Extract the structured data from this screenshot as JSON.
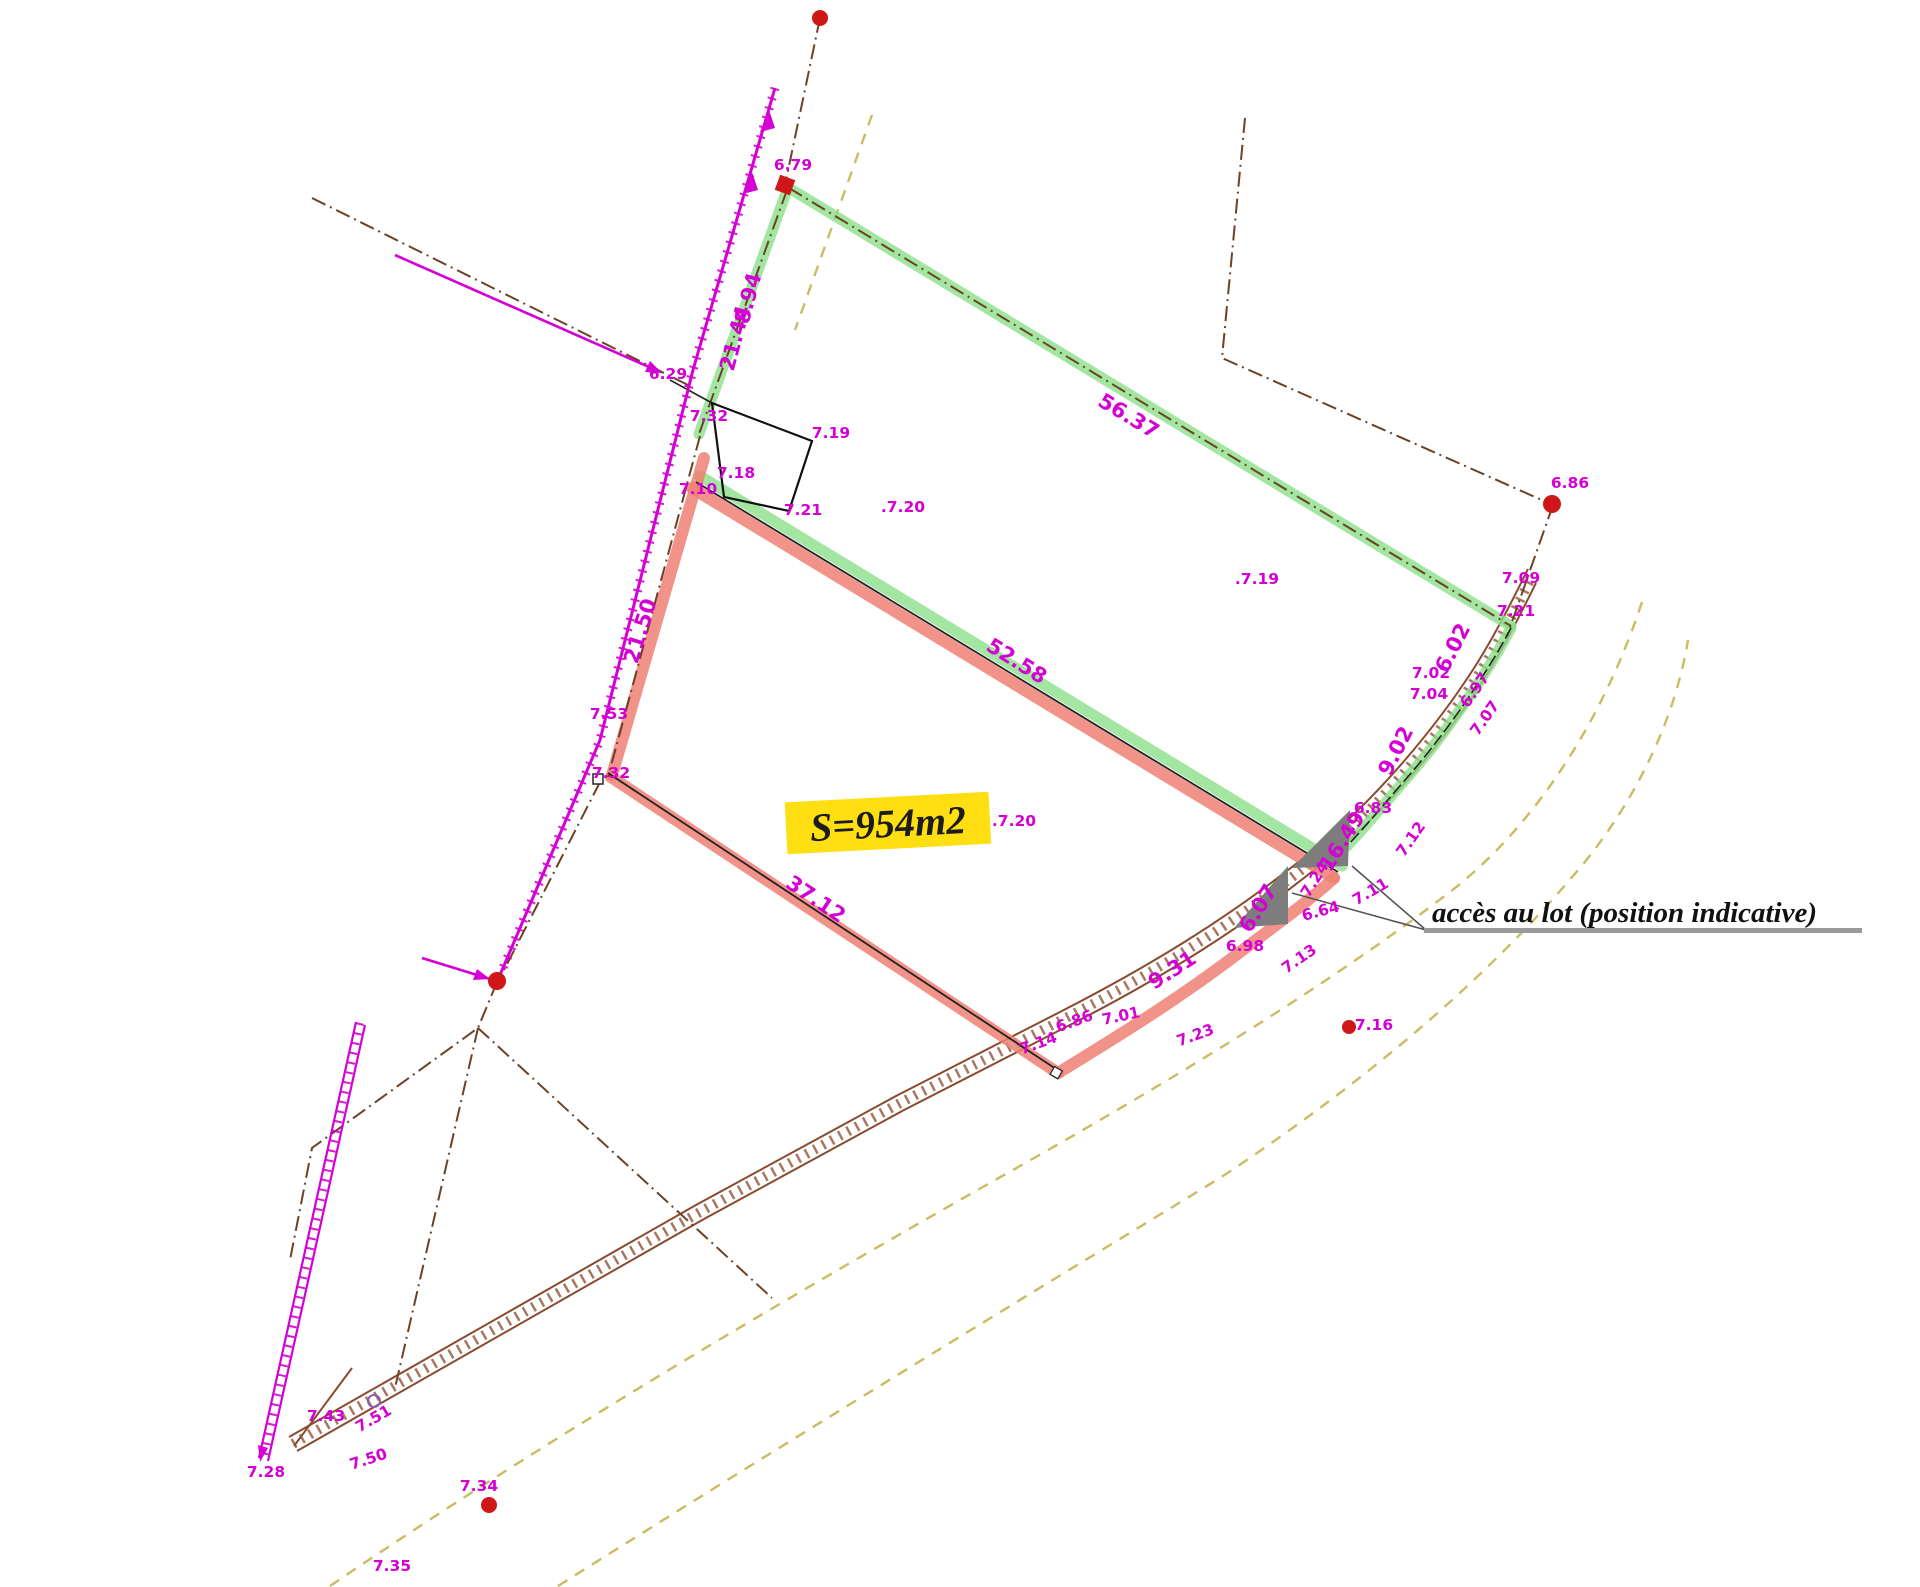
{
  "annotations": {
    "area": {
      "text": "S=954m2"
    },
    "access": {
      "text": "accès au lot (position indicative)"
    }
  },
  "labels": {
    "dimensions": [
      {
        "text": "8.94",
        "x": 755,
        "y": 300,
        "rot": -75
      },
      {
        "text": "21.44",
        "x": 742,
        "y": 340,
        "rot": -75
      },
      {
        "text": "21.50",
        "x": 647,
        "y": 633,
        "rot": -73
      },
      {
        "text": "56.37",
        "x": 1125,
        "y": 422,
        "rot": 31
      },
      {
        "text": "52.58",
        "x": 1013,
        "y": 667,
        "rot": 32
      },
      {
        "text": "37.12",
        "x": 812,
        "y": 905,
        "rot": 34
      },
      {
        "text": "16.49",
        "x": 1348,
        "y": 845,
        "rot": -58
      },
      {
        "text": "9.02",
        "x": 1402,
        "y": 754,
        "rot": -63
      },
      {
        "text": "9.31",
        "x": 1176,
        "y": 976,
        "rot": -33
      },
      {
        "text": "6.02",
        "x": 1459,
        "y": 651,
        "rot": -63
      },
      {
        "text": "6.07",
        "x": 1264,
        "y": 912,
        "rot": -58
      }
    ],
    "elevations": [
      {
        "text": "6.79",
        "x": 793,
        "y": 170
      },
      {
        "text": "6.29",
        "x": 668,
        "y": 379
      },
      {
        "text": "7.32",
        "x": 709,
        "y": 421
      },
      {
        "text": "7.19",
        "x": 831,
        "y": 438
      },
      {
        "text": "7.18",
        "x": 736,
        "y": 478
      },
      {
        "text": "7.10",
        "x": 698,
        "y": 494
      },
      {
        "text": "7.21",
        "x": 803,
        "y": 515
      },
      {
        "text": ".7.20",
        "x": 903,
        "y": 512
      },
      {
        "text": ".7.19",
        "x": 1257,
        "y": 584
      },
      {
        "text": "6.86",
        "x": 1570,
        "y": 488
      },
      {
        "text": "7.09",
        "x": 1521,
        "y": 583
      },
      {
        "text": "7.21",
        "x": 1516,
        "y": 616
      },
      {
        "text": "7.02",
        "x": 1431,
        "y": 678
      },
      {
        "text": "7.04",
        "x": 1429,
        "y": 699
      },
      {
        "text": "6.97",
        "x": 1479,
        "y": 693,
        "rot": -55
      },
      {
        "text": "7.07",
        "x": 1489,
        "y": 721,
        "rot": -55
      },
      {
        "text": "6.83",
        "x": 1373,
        "y": 813
      },
      {
        "text": "7.12",
        "x": 1415,
        "y": 842,
        "rot": -55
      },
      {
        "text": "7.24",
        "x": 1319,
        "y": 882,
        "rot": -58
      },
      {
        "text": "7.11",
        "x": 1373,
        "y": 896,
        "rot": -30
      },
      {
        "text": "6.64",
        "x": 1322,
        "y": 916,
        "rot": -15
      },
      {
        "text": "6.98",
        "x": 1245,
        "y": 951
      },
      {
        "text": "7.13",
        "x": 1302,
        "y": 963,
        "rot": -35
      },
      {
        "text": "7.23",
        "x": 1197,
        "y": 1040,
        "rot": -20
      },
      {
        "text": "7.16",
        "x": 1374,
        "y": 1030
      },
      {
        "text": "6.86",
        "x": 1076,
        "y": 1026,
        "rot": -20
      },
      {
        "text": "7.01",
        "x": 1122,
        "y": 1021,
        "rot": -12
      },
      {
        "text": "7.14",
        "x": 1040,
        "y": 1048,
        "rot": -20
      },
      {
        "text": ".7.20",
        "x": 1014,
        "y": 826
      },
      {
        "text": "7.53",
        "x": 609,
        "y": 719
      },
      {
        "text": "7.32",
        "x": 611,
        "y": 778
      },
      {
        "text": "7.43",
        "x": 326,
        "y": 1421
      },
      {
        "text": "7.51",
        "x": 376,
        "y": 1423,
        "rot": -30
      },
      {
        "text": "7.50",
        "x": 370,
        "y": 1464,
        "rot": -18
      },
      {
        "text": "7.28",
        "x": 266,
        "y": 1477
      },
      {
        "text": "7.34",
        "x": 479,
        "y": 1491
      },
      {
        "text": "7.35",
        "x": 392,
        "y": 1571
      }
    ]
  },
  "colors": {
    "magenta": "#d400d4",
    "green_band": "#8ce08a",
    "red_band": "#ee8073",
    "highlight_yellow": "#ffdf12",
    "road_brown": "#8a4a2e",
    "boundary_brown": "#6b4226",
    "khaki_dash": "#c9bd62",
    "survey_point_red": "#cf1717",
    "access_arrow_gray": "#7d7d7d"
  }
}
